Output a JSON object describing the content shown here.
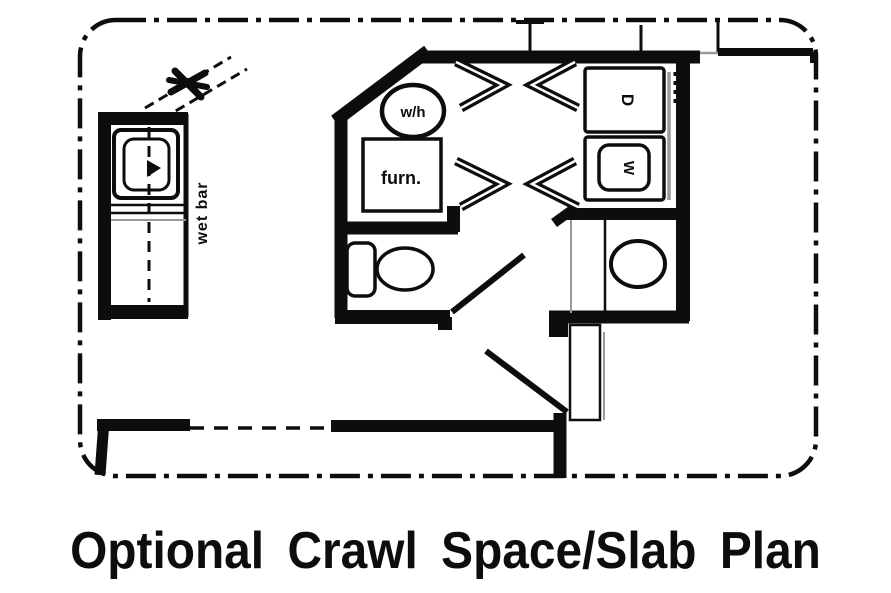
{
  "plan": {
    "caption": "Optional Crawl Space/Slab Plan",
    "labels": {
      "water_heater": "w/h",
      "furnace": "furn.",
      "dryer": "D",
      "washer": "W",
      "wet_bar": "wet bar"
    }
  },
  "colors": {
    "ink": "#0d0d0d",
    "paper": "#ffffff",
    "shadow": "#9a9a9a"
  }
}
